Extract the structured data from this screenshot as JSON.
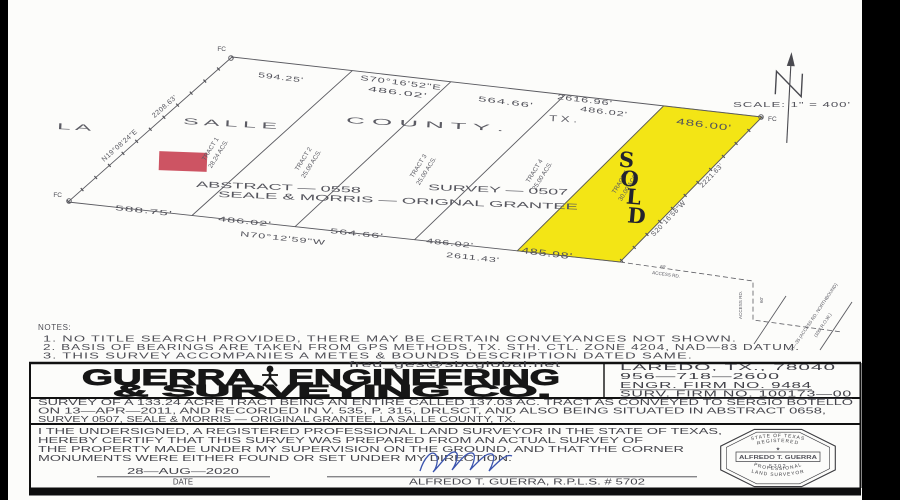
{
  "colors": {
    "sold_yellow": "#f3e515",
    "marker_red": "#cd5463",
    "signature_blue": "#3b54ae",
    "paper": "#fcfcfa"
  },
  "plat": {
    "fc_label": "FC",
    "county_parts": [
      "L A",
      "S A L L E",
      "C O U N T Y .",
      "T X ."
    ],
    "scale_label": "SCALE: 1\" = 400'",
    "top_edge": {
      "d1": "594.25'",
      "bearing": "S70°16'52\"E",
      "d2": "486.02'",
      "d3": "564.66'",
      "total": "2616.96'",
      "d4": "486.02'",
      "d5": "486.00'"
    },
    "bottom_edge": {
      "d1": "588.75'",
      "d2": "486.02'",
      "bearing": "N70°12'59\"W",
      "d3": "564.66'",
      "d4": "486.02'",
      "total": "2611.43'",
      "d5": "485.98'"
    },
    "west_edge": {
      "dist": "2208.63'",
      "bearing": "N19°08'24\"E"
    },
    "east_edge": {
      "dist": "2221.63'",
      "bearing": "S20°16'56\"W"
    },
    "tracts": [
      {
        "name": "TRACT 1",
        "acres": "28.24 ACS."
      },
      {
        "name": "TRACT 2",
        "acres": "25.00 ACS."
      },
      {
        "name": "TRACT 3",
        "acres": "25.00 ACS."
      },
      {
        "name": "TRACT 4",
        "acres": "25.00 ACS."
      },
      {
        "name": "TRACT 5",
        "acres": "30.00 ACS."
      }
    ],
    "abstract_label": "ABSTRACT — 0558",
    "survey_label": "SURVEY — 0507",
    "grantee_label": "SEALE & MORRIS — ORIGNAL GRANTEE",
    "sold_letters": [
      "S",
      "O",
      "L",
      "D"
    ],
    "access_road": {
      "dim": "60'",
      "name": "ACCESS RD.",
      "v_name": "ACCESS RD.",
      "v_dim": "60'",
      "ih35_line1": "IH—35 (ACCESS RD. NORTHBOUND)",
      "ih35_line2": "(100' R.O.W.)"
    }
  },
  "notes": {
    "title": "NOTES:",
    "items": [
      "1.   NO TITLE SEARCH PROVIDED, THERE MAY BE CERTAIN CONVEYANCES NOT SHOWN.",
      "2.   BASIS OF BEARINGS ARE TAKEN FROM GPS METHODS, TX. STH. CTL. ZONE 4204, NAD—83 DATUM.",
      "3.   THIS SURVEY ACCOMPANIES A METES & BOUNDS DESCRIPTION DATED SAME."
    ]
  },
  "title_block": {
    "email": "fred_ges@sbcglobal.net",
    "company_word1": "GUERRA",
    "company_word2": "ENGINEERING",
    "company_line2": "& SURVEYING CO.",
    "address": "LAREDO, TX., 78040",
    "phone": "956—718—2600",
    "engr_firm": "ENGR. FIRM NO. 9484",
    "surv_firm": "SURV. FIRM NO. 100173—00",
    "description_lines": [
      "SURVEY OF A 133.24 ACRE TRACT BEING AN ENTIRE CALLED 137.03 AC. TRACT AS CONVEYED TO SERGIO BOTELLO",
      "ON 13—APR—2011, AND RECORDED IN V. 535, P. 315, DRLSCT, AND ALSO BEING SITUATED IN ABSTRACT 0658,",
      "SURVEY 0507, SEALE & MORRIS — ORIGINAL GRANTEE, LA SALLE COUNTY, TX."
    ],
    "cert_lines": [
      "I THE UNDERSIGNED, A REGISTERED PROFESSIONAL LAND SURVEYOR IN THE STATE OF TEXAS,",
      "HEREBY CERTIFY THAT THIS  SURVEY WAS PREPARED FROM AN ACTUAL SURVEY OF",
      "THE PROPERTY MADE UNDER MY SUPERVISION ON THE GROUND, AND THAT THE CORNER",
      "MONUMENTS WERE EITHER FOUND OR SET UNDER MY DIRECTION."
    ],
    "date_value": "28—AUG—2020",
    "date_label": "DATE",
    "surveyor_name_line": "ALFREDO T. GUERRA, R.P.L.S. # 5702",
    "seal": {
      "state": "STATE OF TEXAS",
      "registered": "REGISTERED",
      "star": "★",
      "name": "ALFREDO T. GUERRA",
      "number": "5702",
      "professional": "PROFESSIONAL",
      "land": "LAND SURVEYOR"
    }
  }
}
